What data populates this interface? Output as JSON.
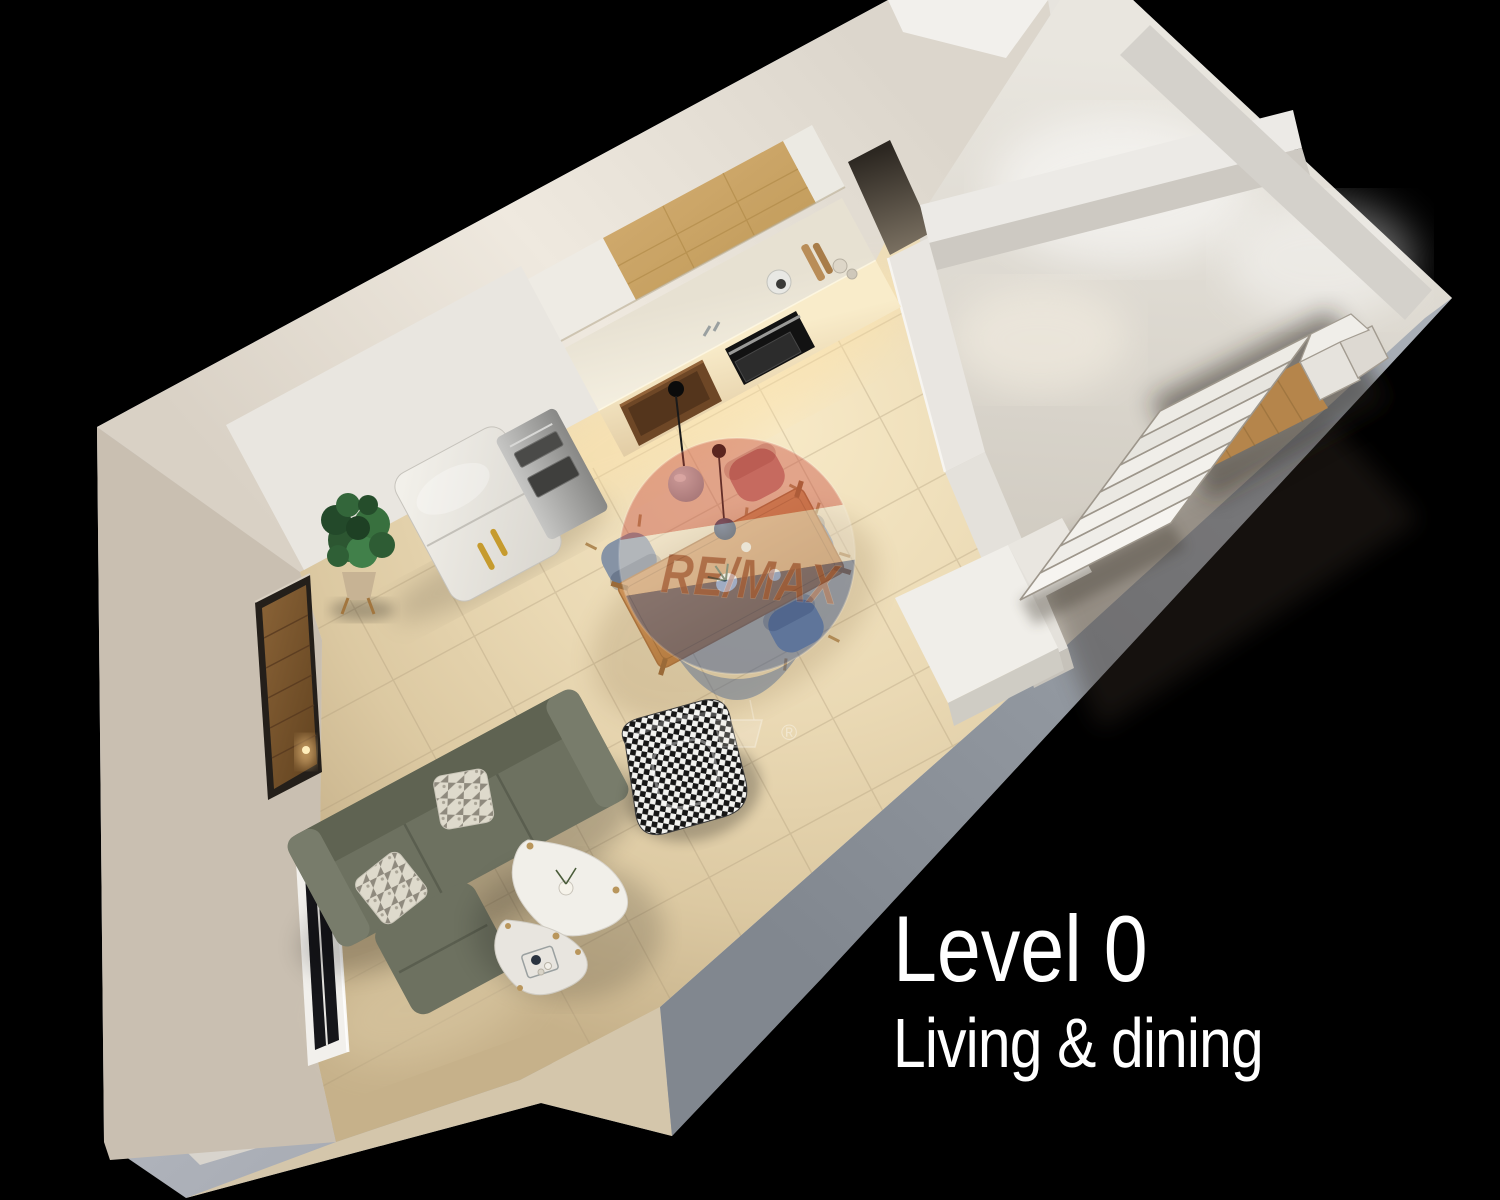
{
  "page": {
    "width": 1500,
    "height": 1200,
    "background": "#000000",
    "description": "3D aerial cutaway floor-plan render of an apartment level on a black background"
  },
  "caption": {
    "title": "Level 0",
    "subtitle": "Living & dining"
  },
  "watermark": {
    "brand": "RE/MAX",
    "registered_mark": "®",
    "balloon_top_color": "#c94a3c",
    "balloon_middle_color": "#efe7d8",
    "balloon_bottom_color": "#2f4f8e",
    "text_color": "#7d2a1e"
  },
  "palette": {
    "background": "#000000",
    "outer_wall": "#b4b8bf",
    "wall_top": "#e7e4de",
    "floor": "#ead9b6",
    "kitchen_wood": "#c9a468",
    "counter": "#f6f1e3",
    "sofa": "#6d7160",
    "dining_table": "#c08a52",
    "stair_void_wood": "#b5854b",
    "caption_text": "#ffffff"
  },
  "scene": {
    "view": "top-down 3D cutaway",
    "areas": [
      {
        "name": "kitchen",
        "items": [
          "white upper cabinets",
          "oak cabinet band",
          "lit counter",
          "dark sink niche",
          "built-in black oven",
          "fridge with brass handles",
          "stainless appliance tower",
          "pot",
          "cutting boards",
          "jars"
        ]
      },
      {
        "name": "dining",
        "items": [
          "wooden dining table",
          "three blue-grey chairs",
          "pink chair",
          "navy chair",
          "grey pendant lamp",
          "navy pendant lamp"
        ]
      },
      {
        "name": "living",
        "items": [
          "olive-green sofa with chaise",
          "two patterned cushions",
          "houndstooth armchair",
          "two white nesting coffee tables",
          "potted plant"
        ]
      },
      {
        "name": "stair-hall",
        "items": [
          "descending stair flight",
          "winder steps",
          "stair void with lower-level wood floor",
          "white landing blocks"
        ]
      },
      {
        "name": "walls",
        "items": [
          "window recess",
          "wooden door opening",
          "upper corridor opening"
        ]
      }
    ]
  }
}
